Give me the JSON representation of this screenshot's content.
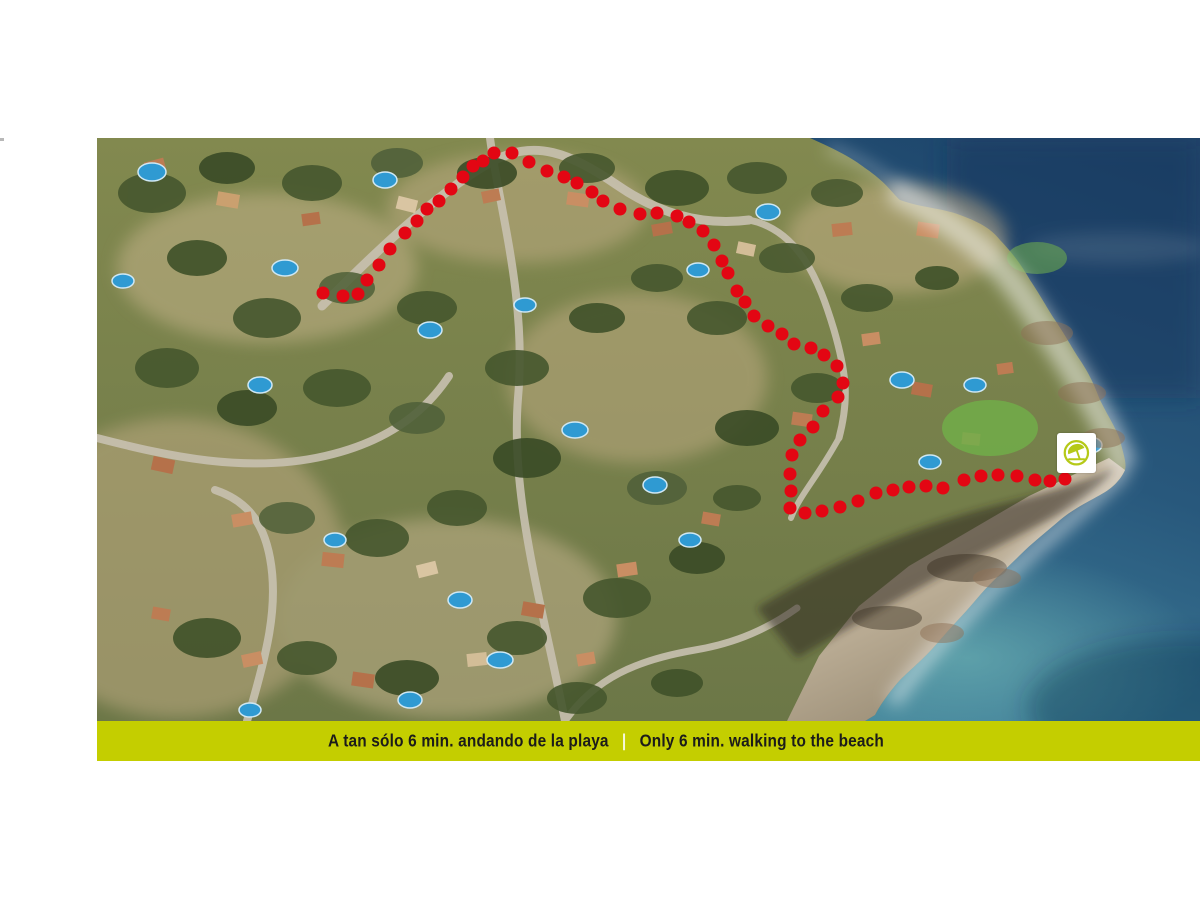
{
  "page": {
    "background": "#ffffff"
  },
  "map": {
    "route": {
      "color": "#e30613",
      "dot_radius": 6.5,
      "points": [
        [
          226,
          155
        ],
        [
          246,
          158
        ],
        [
          261,
          156
        ],
        [
          270,
          142
        ],
        [
          282,
          127
        ],
        [
          293,
          111
        ],
        [
          308,
          95
        ],
        [
          320,
          83
        ],
        [
          330,
          71
        ],
        [
          342,
          63
        ],
        [
          354,
          51
        ],
        [
          366,
          39
        ],
        [
          376,
          28
        ],
        [
          386,
          23
        ],
        [
          397,
          15
        ],
        [
          415,
          15
        ],
        [
          432,
          24
        ],
        [
          450,
          33
        ],
        [
          467,
          39
        ],
        [
          480,
          45
        ],
        [
          495,
          54
        ],
        [
          506,
          63
        ],
        [
          523,
          71
        ],
        [
          543,
          76
        ],
        [
          560,
          75
        ],
        [
          580,
          78
        ],
        [
          592,
          84
        ],
        [
          606,
          93
        ],
        [
          617,
          107
        ],
        [
          625,
          123
        ],
        [
          631,
          135
        ],
        [
          640,
          153
        ],
        [
          648,
          164
        ],
        [
          657,
          178
        ],
        [
          671,
          188
        ],
        [
          685,
          196
        ],
        [
          697,
          206
        ],
        [
          714,
          210
        ],
        [
          727,
          217
        ],
        [
          740,
          228
        ],
        [
          746,
          245
        ],
        [
          741,
          259
        ],
        [
          726,
          273
        ],
        [
          716,
          289
        ],
        [
          703,
          302
        ],
        [
          695,
          317
        ],
        [
          693,
          336
        ],
        [
          694,
          353
        ],
        [
          693,
          370
        ],
        [
          708,
          375
        ],
        [
          725,
          373
        ],
        [
          743,
          369
        ],
        [
          761,
          363
        ],
        [
          779,
          355
        ],
        [
          796,
          352
        ],
        [
          812,
          349
        ],
        [
          829,
          348
        ],
        [
          846,
          350
        ],
        [
          867,
          342
        ],
        [
          884,
          338
        ],
        [
          901,
          337
        ],
        [
          920,
          338
        ],
        [
          938,
          342
        ],
        [
          953,
          343
        ],
        [
          968,
          341
        ]
      ]
    },
    "beach_marker": {
      "icon": "beach-umbrella-icon",
      "x": 960,
      "y": 295,
      "width": 39,
      "height": 40,
      "box_color": "#ffffff",
      "accent_color": "#b5c918"
    }
  },
  "caption_bar": {
    "background": "#c4ce00",
    "text_color": "#1c1c1a",
    "divider": "|",
    "divider_color": "#ffffff",
    "label_es": "A tan sólo 6 min. andando de la playa",
    "label_en": "Only 6 min. walking to the beach"
  }
}
